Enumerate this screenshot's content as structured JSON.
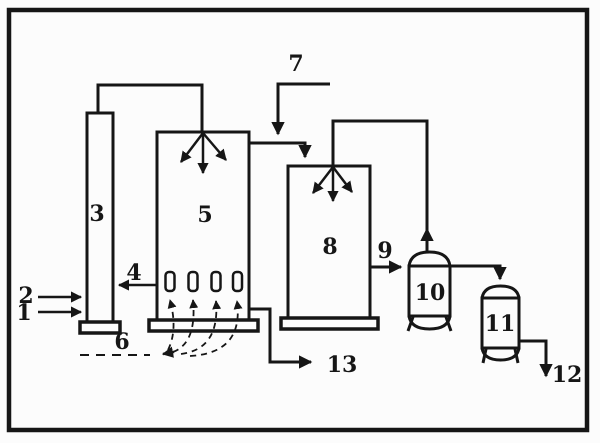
{
  "colors": {
    "ink": "#161616",
    "paper": "#fcfcfc"
  },
  "diagram": {
    "kind": "process-flow-diagram",
    "labels": {
      "n1": "1",
      "n2": "2",
      "n3": "3",
      "n4": "4",
      "n5": "5",
      "n6": "6",
      "n7": "7",
      "n8": "8",
      "n9": "9",
      "n10": "10",
      "n11": "11",
      "n12": "12",
      "n13": "13"
    }
  }
}
